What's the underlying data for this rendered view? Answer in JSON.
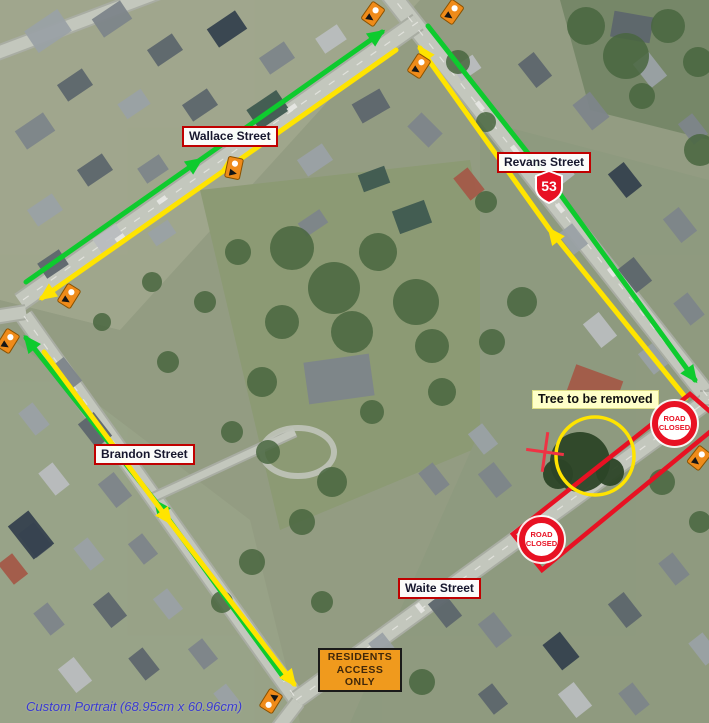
{
  "map": {
    "kind": "aerial traffic-management / road-closure plan"
  },
  "labels": {
    "wallace_street": "Wallace Street",
    "revans_street": "Revans Street",
    "brandon_street": "Brandon Street",
    "waite_street": "Waite Street",
    "tree_note": "Tree to be removed"
  },
  "signs": {
    "highway_shield": "53",
    "road_closed": {
      "line1": "ROAD",
      "line2": "CLOSED"
    },
    "residents_access": {
      "lines": [
        "RESIDENTS",
        "ACCESS",
        "ONLY"
      ]
    }
  },
  "footer": {
    "note": "Custom Portrait (68.95cm x 60.96cm)"
  },
  "icons": {
    "roadwork_marker": "orange-roadwork-sign-icon",
    "road_closed_sign": "road-closed-circle-sign-icon",
    "highway_shield": "state-highway-shield-icon",
    "tree_marker_cross": "red-cross-marker-icon",
    "tree_highlight": "yellow-circle-highlight"
  },
  "colors": {
    "detour-green": "#0ecb2e",
    "detour-yellow": "#ffe400",
    "closure-red": "#e81123",
    "label-border": "#c00000",
    "label-text": "#17172e",
    "sign-orange": "#f09a1d",
    "note-bg": "#ffffc8",
    "footer-blue": "#3a3ad0",
    "marker-orange": "#ef8b1a"
  }
}
